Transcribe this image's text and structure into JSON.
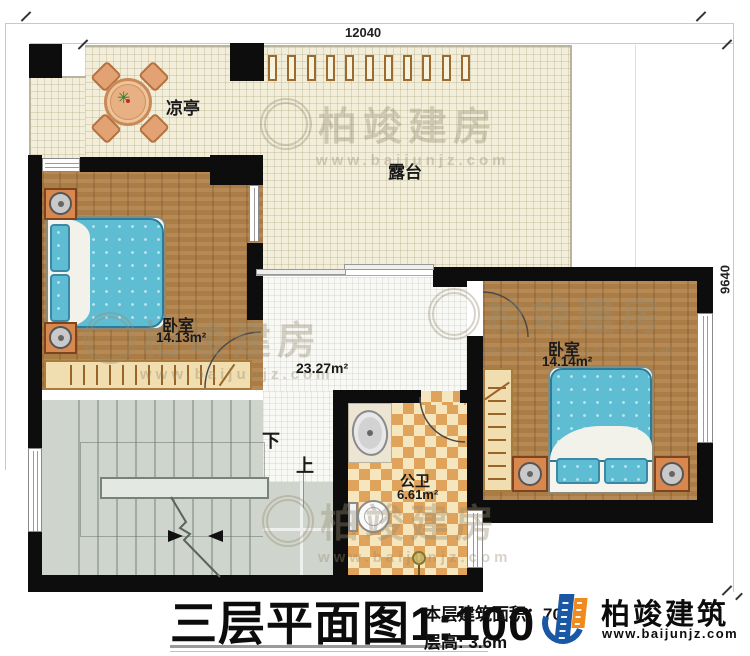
{
  "plan": {
    "dimensions": {
      "top": "12040",
      "right": "9640"
    },
    "rooms": {
      "pavilion": {
        "label": "凉亭"
      },
      "terrace": {
        "label": "露台",
        "railing_post_count": 11
      },
      "bedroom_left": {
        "label": "卧室",
        "area": "14.13m²"
      },
      "bedroom_right": {
        "label": "卧室",
        "area": "14.14m²"
      },
      "hall": {
        "area": "23.27m²"
      },
      "bathroom": {
        "label": "公卫",
        "area": "6.61m²"
      },
      "stairs": {
        "down": "下",
        "up": "上"
      }
    }
  },
  "title_block": {
    "title": "三层平面图",
    "scale": "1:100",
    "area_line": "本层建筑面积：70",
    "height_line": "层高: 3.6m"
  },
  "branding": {
    "company": "柏竣建筑",
    "website": "www.baijunjz.com",
    "watermark_text": "柏竣建房",
    "watermark_url": "www.baijunjz.com"
  },
  "colors": {
    "wall": "#0d0d0d",
    "wood": "#b1824a",
    "terrace": "#f2eeda",
    "stair": "#cfd5cd",
    "checker_dark": "#dfa35c",
    "checker_light": "#f6e6bd",
    "bed_blue": "#5fbdd3",
    "logo_blue": "#1a57a5",
    "logo_orange": "#f08a1d"
  }
}
